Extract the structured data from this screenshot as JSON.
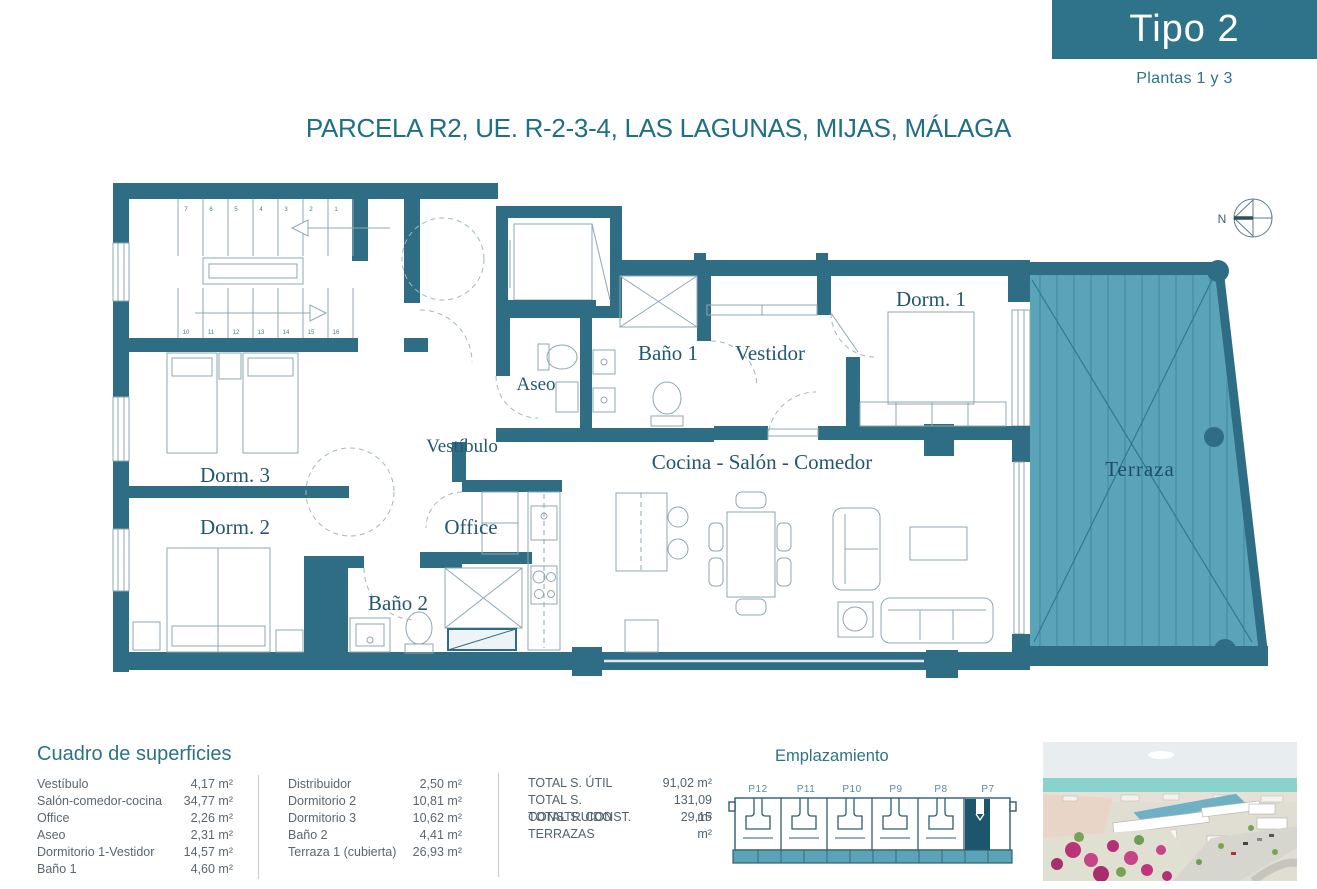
{
  "header": {
    "type_label": "Tipo 2",
    "floors_label": "Plantas 1 y 3"
  },
  "title": "PARCELA R2, UE. R-2-3-4, LAS LAGUNAS, MIJAS, MÁLAGA",
  "floorplan": {
    "rooms": {
      "vestibulo": "Vestíbulo",
      "dorm3": "Dorm. 3",
      "dorm2": "Dorm. 2",
      "office": "Office",
      "bano2": "Baño 2",
      "aseo": "Aseo",
      "bano1": "Baño 1",
      "vestidor": "Vestidor",
      "dorm1": "Dorm. 1",
      "salon": "Cocina - Salón - Comedor",
      "terraza": "Terraza"
    },
    "compass_label": "N",
    "stair_numbers_top": [
      "7",
      "6",
      "5",
      "4",
      "3",
      "2",
      "1"
    ],
    "stair_numbers_bottom": [
      "10",
      "11",
      "12",
      "13",
      "14",
      "15",
      "16"
    ]
  },
  "surfaces": {
    "heading": "Cuadro de superficies",
    "col1": [
      {
        "label": "Vestíbulo",
        "value": "4,17 m²"
      },
      {
        "label": "Salón-comedor-cocina",
        "value": "34,77 m²"
      },
      {
        "label": "Office",
        "value": "2,26 m²"
      },
      {
        "label": "Aseo",
        "value": "2,31 m²"
      },
      {
        "label": "Dormitorio 1-Vestidor",
        "value": "14,57 m²"
      },
      {
        "label": "Baño 1",
        "value": "4,60 m²"
      }
    ],
    "col2": [
      {
        "label": "Distribuidor",
        "value": "2,50 m²"
      },
      {
        "label": "Dormitorio 2",
        "value": "10,81 m²"
      },
      {
        "label": "Dormitorio 3",
        "value": "10,62 m²"
      },
      {
        "label": "Baño 2",
        "value": "4,41 m²"
      },
      {
        "label": "Terraza 1 (cubierta)",
        "value": "26,93 m²"
      }
    ],
    "totals": [
      {
        "label": "TOTAL S. ÚTIL",
        "value": "91,02 m²"
      },
      {
        "label": "TOTAL S. CONSTRUIDO",
        "value": "131,09 m²"
      },
      {
        "label": "TOTAL S. CONST. TERRAZAS",
        "value": "29,15 m²"
      }
    ]
  },
  "emplazamiento": {
    "title": "Emplazamiento",
    "plots": [
      "P12",
      "P11",
      "P10",
      "P9",
      "P8",
      "P7"
    ],
    "highlighted_plot": "P7"
  },
  "colors": {
    "brand_teal": "#2e7389",
    "wall": "#2e6d84",
    "terrace_fill": "#5ba4b7",
    "label_ink": "#24586e",
    "table_ink": "#5b6670"
  }
}
